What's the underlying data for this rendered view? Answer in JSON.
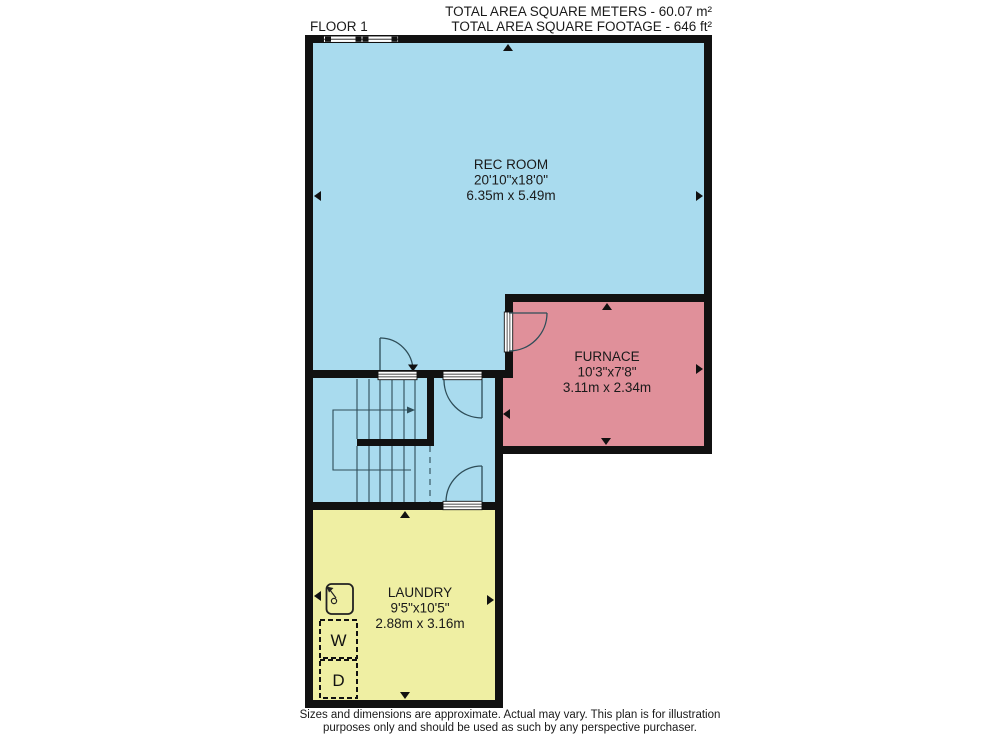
{
  "header": {
    "floor_label": "FLOOR 1",
    "total_area_metric": "TOTAL AREA SQUARE METERS - 60.07 m²",
    "total_area_imperial": "TOTAL AREA SQUARE FOOTAGE - 646 ft²"
  },
  "rooms": {
    "rec_room": {
      "name": "REC ROOM",
      "dims_imperial": "20'10\"x18'0\"",
      "dims_metric": "6.35m x 5.49m",
      "color": "#a9dbee"
    },
    "furnace": {
      "name": "FURNACE",
      "dims_imperial": "10'3\"x7'8\"",
      "dims_metric": "3.11m x 2.34m",
      "color": "#e0909a"
    },
    "laundry": {
      "name": "LAUNDRY",
      "dims_imperial": "9'5\"x10'5\"",
      "dims_metric": "2.88m x 3.16m",
      "color": "#efefa3"
    }
  },
  "appliances": {
    "washer_label": "W",
    "dryer_label": "D"
  },
  "footer": {
    "line1": "Sizes and dimensions are approximate. Actual may vary. This plan is for illustration",
    "line2": "purposes only and should be used as such by any perspective purchaser."
  },
  "colors": {
    "wall": "#111111",
    "line": "#2e4d58",
    "arrow": "#111111",
    "opening_fill": "#ffffff"
  }
}
